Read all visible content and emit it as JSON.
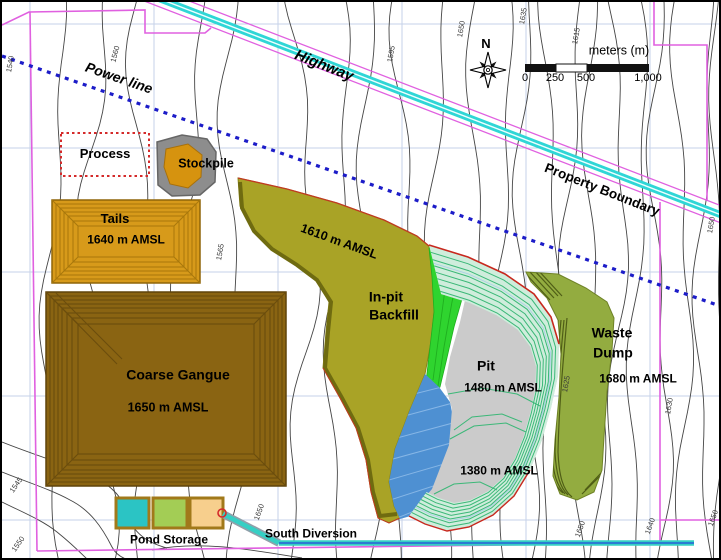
{
  "figure": {
    "title_hint": "mine site layout plan",
    "compass": {
      "north_label": "N"
    },
    "scale_bar": {
      "unit_label": "meters (m)",
      "ticks": [
        "0",
        "250",
        "500",
        "1,000"
      ]
    },
    "corridors": {
      "power_line": "Power line",
      "highway": "Highway",
      "property_boundary": "Property Boundary"
    },
    "facilities": {
      "process": {
        "name": "Process"
      },
      "stockpile": {
        "name": "Stockpile"
      },
      "tails": {
        "name": "Tails",
        "elevation": "1640 m AMSL"
      },
      "coarse_gangue": {
        "name": "Coarse Gangue",
        "elevation": "1650 m AMSL"
      },
      "inpit_backfill": {
        "name_line1": "In-pit",
        "name_line2": "Backfill",
        "elevation": "1610 m AMSL"
      },
      "pit": {
        "name": "Pit",
        "upper_elevation": "1480 m AMSL",
        "lower_elevation": "1380 m AMSL"
      },
      "waste_dump": {
        "name_line1": "Waste",
        "name_line2": "Dump",
        "elevation": "1680 m AMSL"
      },
      "pond_storage": {
        "name": "Pond Storage"
      },
      "south_diversion": {
        "name": "South Diversion"
      }
    },
    "contour_elevation_labels": [
      {
        "value": "1540",
        "x": 8,
        "y": 62,
        "rot": -80
      },
      {
        "value": "1560",
        "x": 113,
        "y": 52,
        "rot": -75
      },
      {
        "value": "1545",
        "x": 14,
        "y": 483,
        "rot": -55
      },
      {
        "value": "1550",
        "x": 16,
        "y": 542,
        "rot": -55
      },
      {
        "value": "1565",
        "x": 218,
        "y": 250,
        "rot": -80
      },
      {
        "value": "1595",
        "x": 389,
        "y": 52,
        "rot": -80
      },
      {
        "value": "1650",
        "x": 459,
        "y": 27,
        "rot": -80
      },
      {
        "value": "1635",
        "x": 521,
        "y": 14,
        "rot": -80
      },
      {
        "value": "1615",
        "x": 574,
        "y": 34,
        "rot": -80
      },
      {
        "value": "1650",
        "x": 709,
        "y": 223,
        "rot": -80
      },
      {
        "value": "1625",
        "x": 564,
        "y": 382,
        "rot": -80
      },
      {
        "value": "1630",
        "x": 667,
        "y": 404,
        "rot": -80
      },
      {
        "value": "1650",
        "x": 257,
        "y": 510,
        "rot": -70
      },
      {
        "value": "1650",
        "x": 578,
        "y": 527,
        "rot": -70
      },
      {
        "value": "1640",
        "x": 648,
        "y": 524,
        "rot": -70
      },
      {
        "value": "1650",
        "x": 711,
        "y": 516,
        "rot": -70
      }
    ],
    "colors": {
      "highway_cyan": "#2FD6D6",
      "boundary_magenta": "#E060E0",
      "power_line_blue": "#1C1CC8",
      "process_red": "#D42A2A",
      "stockpile_gray": "#8D8D8D",
      "tails_orange": "#D79A1A",
      "coarse_gangue_brown": "#8A6412",
      "backfill_olive": "#A9A326",
      "bench_green": "#2FD42F",
      "pit_gray": "#CBCBCB",
      "pit_bench_line": "#3CB878",
      "flooded_blue": "#4E90D2",
      "waste_dump_green": "#93AC40",
      "pond_teal": "#2BC4C4",
      "pond_green": "#A3CD55",
      "pond_peach": "#F7CF8D"
    }
  }
}
